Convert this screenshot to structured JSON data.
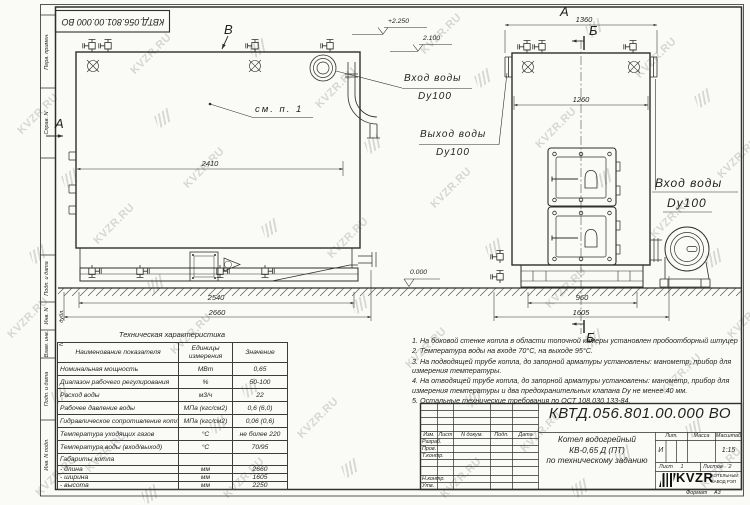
{
  "watermark": {
    "text": "KVZR.RU"
  },
  "frame": {
    "top_designation": "КВТД.056.801.00.000  ВО",
    "side_stamps": [
      "Перв. примен.",
      "Справ. N",
      "Подп. и дата",
      "Инв. N дубл.",
      "Взам. инв. N",
      "Подп. и дата",
      "Инв. N подл."
    ]
  },
  "views": {
    "left": {
      "label_top": "В",
      "label_side": "А",
      "callout": "см. п. 1",
      "dim_inner": "2410",
      "dim_base": "2540",
      "dim_overall": "2660",
      "elev_high": "+2.250",
      "elev_low": "2.100",
      "inlet_label": "Вход воды",
      "inlet_dn": "Dy100",
      "outlet_label": "Выход воды",
      "outlet_dn": "Dy100"
    },
    "right": {
      "label_top": "А",
      "dim_top": "1360",
      "section_top": "Б",
      "dim_inner": "1260",
      "inlet_label": "Вход воды",
      "inlet_dn": "Dy100",
      "dim_base": "960",
      "dim_overall": "1605",
      "section_bottom": "Б",
      "elev_zero": "0.000"
    }
  },
  "table": {
    "title": "Техническая характеристика",
    "headers": {
      "name": "Наименование показателя",
      "units": "Единицы измерения",
      "value": "Значение"
    },
    "rows": [
      {
        "name": "Номинальная мощность",
        "units": "МВт",
        "value": "0,65"
      },
      {
        "name": "Диапазон рабочего регулирования",
        "units": "%",
        "value": "50-100"
      },
      {
        "name": "Расход воды",
        "units": "м3/ч",
        "value": "22"
      },
      {
        "name": "Рабочее давление воды",
        "units": "МПа (кгс/см2)",
        "value": "0,6 (6,0)"
      },
      {
        "name": "Гидравлическое сопротивление котла",
        "units": "МПа (кгс/см2)",
        "value": "0,06 (0,6)"
      },
      {
        "name": "Температура уходящих газов",
        "units": "°С",
        "value": "не более 220"
      },
      {
        "name": "Температура воды (вход/выход)",
        "units": "°С",
        "value": "70/95"
      },
      {
        "name": "Габариты котла",
        "units": "",
        "value": ""
      },
      {
        "name": "- длина",
        "units": "мм",
        "value": "2660"
      },
      {
        "name": "- ширина",
        "units": "мм",
        "value": "1605"
      },
      {
        "name": "- высота",
        "units": "мм",
        "value": "2250"
      }
    ]
  },
  "notes": [
    "1.  На боковой стенке котла в области топочной камеры установлен пробоотборный штуцер",
    "2.  Температура воды на входе  70°С,  на выходе  95°С.",
    "3.  На подводящей трубе котла, до запорной арматуры установлены: манометр, прибор для измерения температуры.",
    "4.  На отводящей трубе котла, до запорной арматуры установлены: манометр, прибор для измерения температуры и два предохранительных клапана  Dу не менее  40 мм.",
    "5.  Остальные технические требования по ОСТ  108.030.133-84."
  ],
  "title_block": {
    "designation": "КВТД.056.801.00.000  ВО",
    "product_line1": "Котел водогрейный",
    "product_line2": "КВ-0,65 Д (ПТ)",
    "product_line3": "по техническому заданию",
    "col_izm": "Изм.",
    "col_list": "Лист",
    "col_docum": "N докум.",
    "col_podp": "Подп.",
    "col_data": "Дата",
    "row_razrab": "Разраб.",
    "row_prov": "Пров.",
    "row_tkontr": "Т.контр.",
    "row_nkontr": "Н.контр.",
    "row_utv": "Утв.",
    "lit_header": "Лит.",
    "mass_header": "Масса",
    "scale_header": "Масштаб",
    "lit_value": "И",
    "scale_value": "1:15",
    "sheet_label": "Лист",
    "sheet_value": "1",
    "sheets_label": "Листов",
    "sheets_value": "2",
    "company_logo": "KVZR",
    "company_line1": "КОТЕЛЬНЫЙ",
    "company_line2": "ЗАВОД РЭП",
    "format_label": "Формат",
    "format_value": "А3"
  }
}
